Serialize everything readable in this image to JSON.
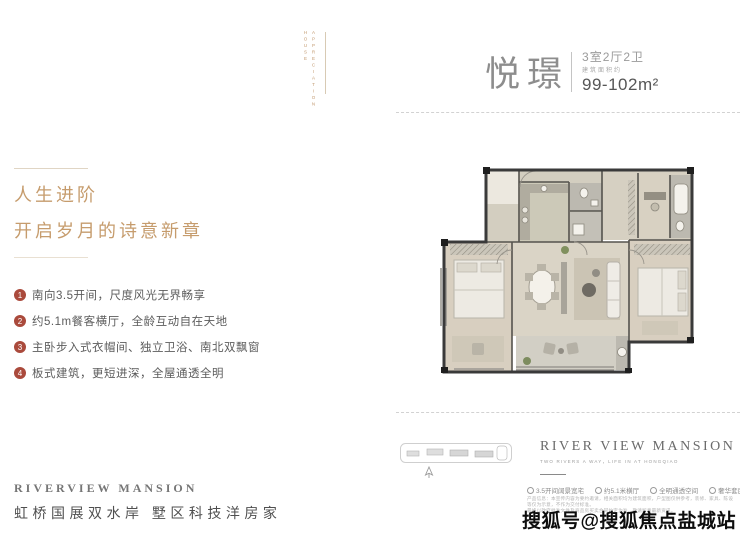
{
  "ornament": {
    "line1": "HOUSE",
    "line2": "APPRECIATION"
  },
  "header": {
    "unit_name": "悦璟",
    "unit_type": "3室2厅2卫",
    "area_prefix": "建筑面积约",
    "area": "99-102m²"
  },
  "intro": {
    "line1": "人生进阶",
    "line2": "开启岁月的诗意新章"
  },
  "features": [
    {
      "num": "1",
      "text": "南向3.5开间，尺度风光无界畅享"
    },
    {
      "num": "2",
      "text": "约5.1m餐客横厅，全龄互动自在天地"
    },
    {
      "num": "3",
      "text": "主卧步入式衣帽间、独立卫浴、南北双飘窗"
    },
    {
      "num": "4",
      "text": "板式建筑，更短进深，全屋通透全明"
    }
  ],
  "brand_right": {
    "en": "RIVER VIEW MANSION",
    "tagline": "TWO RIVERS A WAY，LIFE IN AT HONGQIAO"
  },
  "legend": [
    "3.5开间阔景宽宅",
    "约5.1米横厅",
    "全明通透空间",
    "奢华套房主卧"
  ],
  "disclaimer": [
    "产品信息：本宣传内容为要约邀请，相关面积均为建筑面积，户型图仅供参考，装修、家具、陈设等仅为示意，不作为交付标准。",
    "最终以政府批准文件及商品房买卖合同约定为准，敬请留意最新资讯。"
  ],
  "brand_left": {
    "en": "RIVERVIEW MANSION",
    "cn": "虹桥国展双水岸  墅区科技洋房家"
  },
  "watermark": "搜狐号@搜狐焦点盐城站",
  "colors": {
    "accent_gold": "#c69c6d",
    "bullet_red": "#aa4a3c",
    "title_gray": "#8d8d8d",
    "watermark_black": "#0d0d0d"
  }
}
